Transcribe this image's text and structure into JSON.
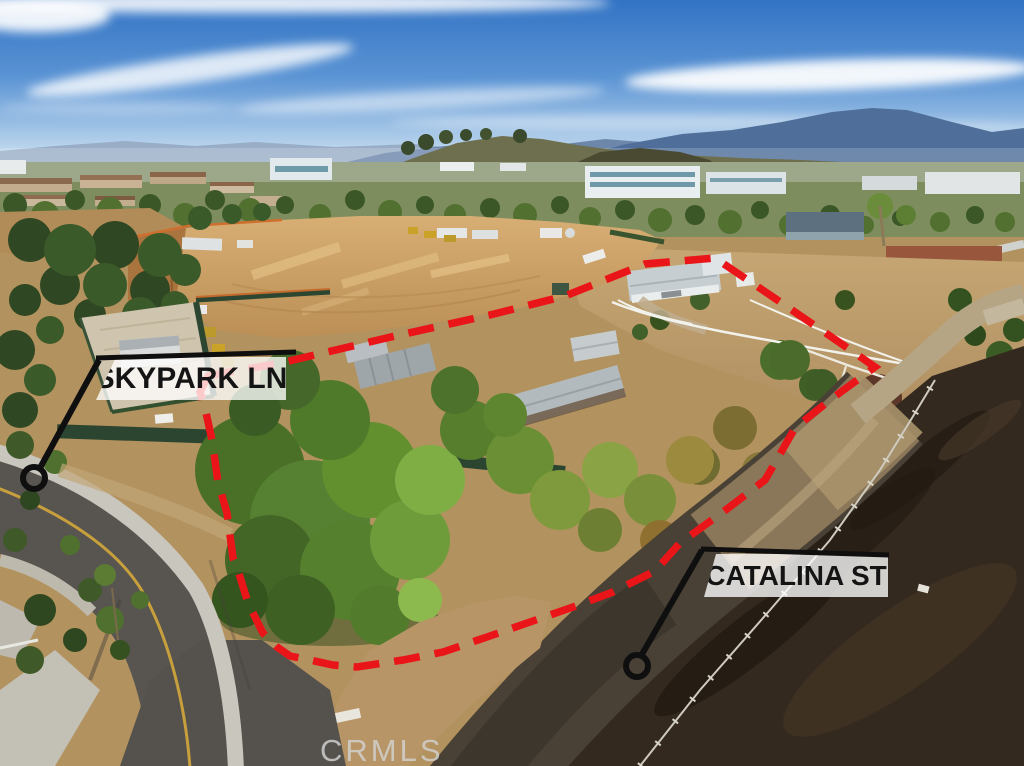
{
  "photo": {
    "type": "aerial-drone-photo",
    "watermark": "CRMLS"
  },
  "callouts": [
    {
      "id": "skypark",
      "label": "SKYPARK LN"
    },
    {
      "id": "catalina",
      "label": "CATALINA ST"
    }
  ],
  "colors": {
    "boundary_red": "#ea1519",
    "callout_black": "#0f0f0f",
    "label_background": "rgba(255,255,255,0.78)",
    "label_text": "#141414",
    "watermark_gray": "#d2d2d2"
  }
}
